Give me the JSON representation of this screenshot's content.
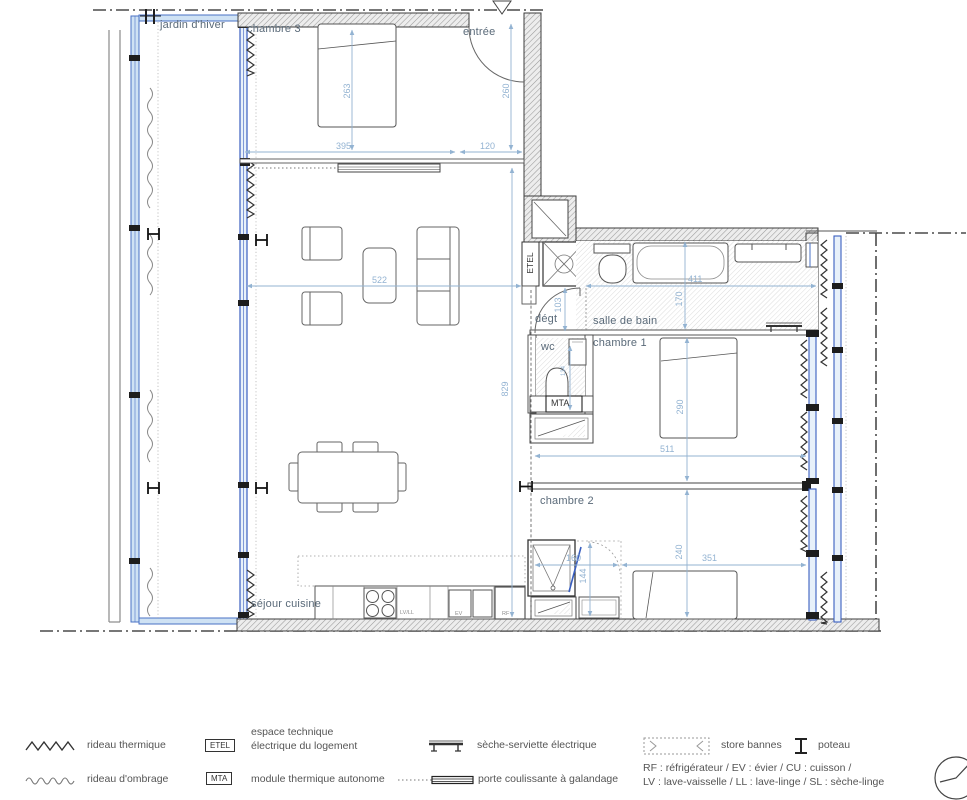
{
  "plan": {
    "rooms": {
      "jardin": "jardin d'hiver",
      "chambre3": "chambre 3",
      "entree": "entrée",
      "degt": "dégt",
      "sdb": "salle de bain",
      "wc": "wc",
      "chambre1": "chambre 1",
      "chambre2": "chambre 2",
      "sejour": "séjour cuisine"
    },
    "tags": {
      "etel": "ETEL",
      "mta": "MTA",
      "lvll": "LV/LL",
      "ev": "EV",
      "rf": "RF"
    },
    "dims": {
      "d263": "263",
      "d395": "395",
      "d120": "120",
      "d260": "260",
      "d522": "522",
      "d103": "103",
      "d411": "411",
      "d170": "170",
      "d829": "829",
      "d290": "290",
      "d511": "511",
      "d240": "240",
      "d160": "160",
      "d351": "351",
      "d144": "144",
      "d134": "134"
    },
    "colors": {
      "glazing_blue": "#3a5fc0",
      "dimension_blue": "#93b3d2",
      "wall_dark": "#3c3c3c"
    }
  },
  "legend": {
    "rideau_thermique": "rideau thermique",
    "rideau_ombrage": "rideau d'ombrage",
    "etel_tag": "ETEL",
    "etel_label_1": "espace technique",
    "etel_label_2": "électrique du logement",
    "mta_tag": "MTA",
    "mta_label": "module thermique autonome",
    "seche_serviette": "sèche-serviette électrique",
    "porte_coulissante": "porte coulissante à galandage",
    "store_bannes": "store bannes",
    "poteau": "poteau",
    "abbr_line_1": "RF : réfrigérateur / EV : évier / CU : cuisson /",
    "abbr_line_2": "LV : lave-vaisselle / LL : lave-linge / SL : sèche-linge"
  }
}
